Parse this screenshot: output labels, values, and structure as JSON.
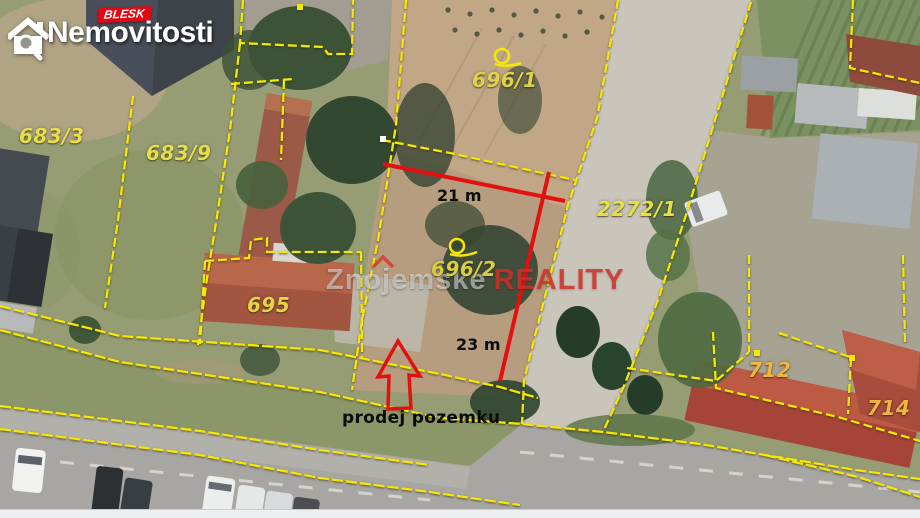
{
  "palette": {
    "parcel_line_yellow": "#f7e800",
    "measure_red": "#e31010",
    "label_yellow": "#e4df4a",
    "label_orange": "#f0b440",
    "annotation_black": "#0a0a0a",
    "watermark_gray": "rgba(240,240,240,0.55)",
    "watermark_red": "rgba(214,48,42,0.82)",
    "logo_badge_red": "#e30613",
    "logo_white": "#ffffff",
    "bottom_bar": "#eceef2"
  },
  "logo": {
    "badge": "BLESK",
    "name": "Nemovitosti",
    "icon": "house-magnifier-icon"
  },
  "watermark": {
    "word1": "Znojemske",
    "word2": "REALITY",
    "accent": "red-roof-icon"
  },
  "parcels": [
    {
      "number": "683/3",
      "color": "#e4df4a"
    },
    {
      "number": "683/9",
      "color": "#e4df4a"
    },
    {
      "number": "696/1",
      "color": "#ded24a"
    },
    {
      "number": "2272/1",
      "color": "#e7e044"
    },
    {
      "number": "696/2",
      "color": "#d9cc45"
    },
    {
      "number": "695",
      "color": "#e7d243"
    },
    {
      "number": "712",
      "color": "#f0b440"
    },
    {
      "number": "714",
      "color": "#f0b440"
    }
  ],
  "measurements": [
    {
      "label": "21 m"
    },
    {
      "label": "23 m"
    }
  ],
  "annotation": {
    "label": "prodej pozemku",
    "arrow": "up-arrow-outline-icon"
  },
  "map_symbols": [
    {
      "name": "garden-glyph",
      "location": "parcel 696/1"
    },
    {
      "name": "garden-glyph",
      "location": "parcel 696/2"
    }
  ]
}
